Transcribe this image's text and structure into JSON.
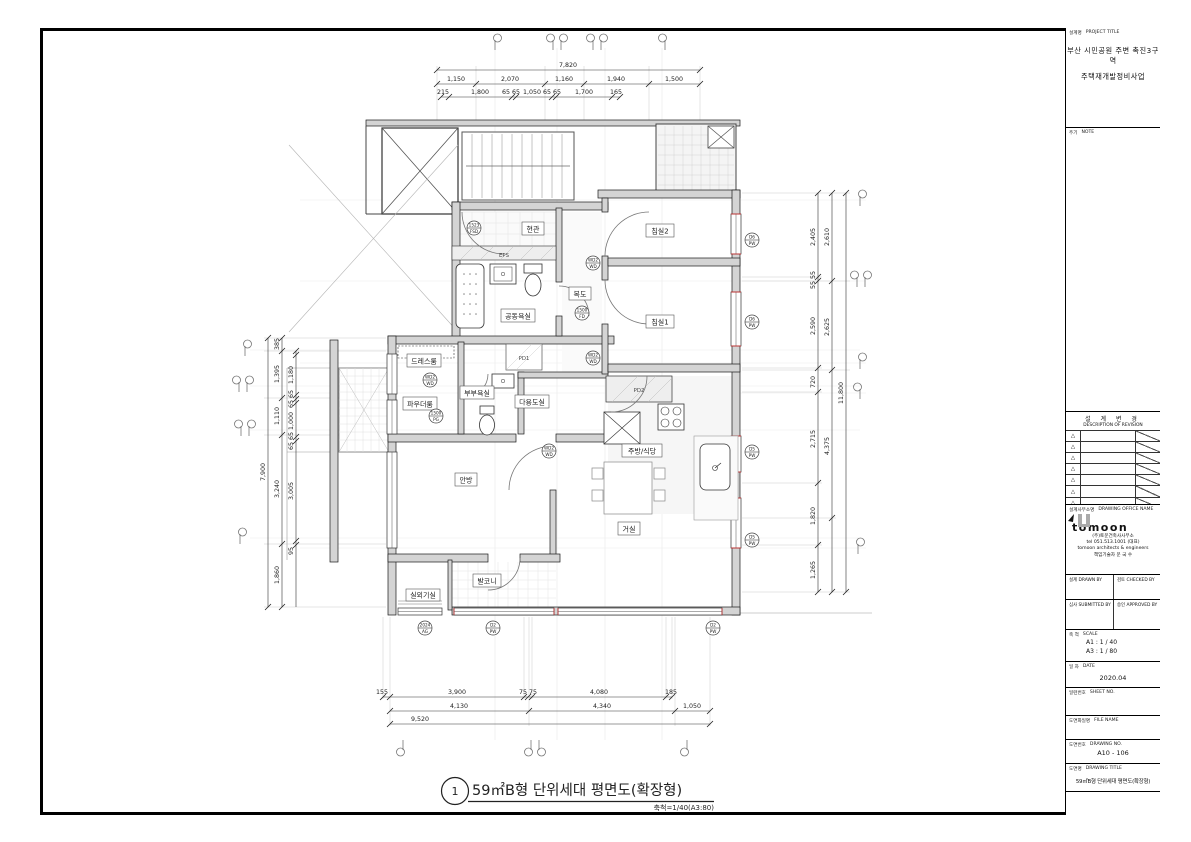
{
  "page": {
    "number": "1",
    "title": "59㎡B형 단위세대 평면도(확장형)",
    "scale_note": "축척=1/40(A3:80)"
  },
  "title_block": {
    "project_label": "설계명",
    "project_label_en": "PROJECT TITLE",
    "project_line1": "부산 시민공원 주변 촉진3구역",
    "project_line2": "주택재개발정비사업",
    "note_label": "주기",
    "note_label_en": "NOTE",
    "revision_label": "설 계 변 경",
    "revision_label_en": "DESCRIPTION OF REVISION",
    "revision_marker": "△",
    "office_label": "설계사무소명",
    "office_label_en": "DRAWING OFFICE NAME",
    "office_logo": "tomoon",
    "office_name": "(주)토문건축사사무소",
    "office_tel": "tel 051.513.1001 (대표)",
    "office_sub": "tomoon architects & engineers",
    "office_engineer": "책임기술자  문  국  수",
    "drawn_label": "설계  DRAWN BY",
    "checked_label": "검토  CHECKED BY",
    "submitted_label": "심사  SUBMITTED BY",
    "approved_label": "승인  APPROVED BY",
    "scale_label": "축 척",
    "scale_label_en": "SCALE",
    "scale_a1": "A1 : 1 /  40",
    "scale_a3": "A3 : 1 /  80",
    "date_label": "일 자",
    "date_label_en": "DATE",
    "date_value": "2020.04",
    "sheet_no_label": "일련번호",
    "sheet_no_label_en": "SHEET NO.",
    "file_name_label": "도면화일명",
    "file_name_label_en": "FILE NAME",
    "drawing_no_label": "도면번호",
    "drawing_no_label_en": "DRAWING NO.",
    "drawing_no_value": "A10 - 106",
    "drawing_title_label": "도면명",
    "drawing_title_label_en": "DRAWING TITLE",
    "drawing_title_value": "59㎡B형 단위세대 평면도(확장형)"
  },
  "rooms": {
    "entry": "현관",
    "eps": "EPS",
    "common_bath": "공동욕실",
    "corridor": "복도",
    "bedroom2": "침실2",
    "bedroom1": "침실1",
    "dress": "드레스룸",
    "powder": "파우더룸",
    "master_bath": "부부욕실",
    "utility": "다용도실",
    "master_bedroom": "안방",
    "kitchen": "주방/식당",
    "living": "거실",
    "balcony": "발코니",
    "ac_room": "실외기실",
    "pd1": "PD1",
    "pd2": "PD2"
  },
  "tags": [
    {
      "t": "1523",
      "b": "FSD"
    },
    {
      "t": "WD2",
      "b": "WD"
    },
    {
      "t": "1500",
      "b": "FD"
    },
    {
      "t": "D6",
      "b": "PW"
    },
    {
      "t": "D6",
      "b": "PW"
    },
    {
      "t": "WD2",
      "b": "WD"
    },
    {
      "t": "WD2",
      "b": "WD"
    },
    {
      "t": "1500",
      "b": "PG"
    },
    {
      "t": "WD2",
      "b": "WD"
    },
    {
      "t": "D5",
      "b": "PW"
    },
    {
      "t": "D5",
      "b": "PW"
    },
    {
      "t": "2024",
      "b": "AG"
    },
    {
      "t": "D2",
      "b": "PW"
    },
    {
      "t": "D2",
      "b": "PW"
    }
  ],
  "dims": {
    "top_total": "7,820",
    "top": [
      "1,150",
      "2,070",
      "1,160",
      "1,940",
      "1,500"
    ],
    "top_sub": [
      "215",
      "1,800",
      "65 65",
      "1,050",
      "65 65",
      "1,700",
      "165"
    ],
    "left_total": "7,900",
    "left": [
      "385",
      "1,395",
      "1,110",
      "3,240",
      "1,860"
    ],
    "left_sub": [
      "1,180",
      "65 65",
      "1,000",
      "65 65",
      "3,005",
      "95"
    ],
    "right_total": "11,800",
    "right_inner": [
      "2,405",
      "55 55",
      "2,590",
      "720",
      "2,715",
      "1,820",
      "1,265"
    ],
    "right_outer": [
      "2,610",
      "2,625",
      "4,375"
    ],
    "bottom_sub": [
      "155",
      "3,900",
      "75 75",
      "4,080",
      "185"
    ],
    "bottom": [
      "4,130",
      "4,340",
      "1,050"
    ],
    "bottom_total": "9,520"
  }
}
